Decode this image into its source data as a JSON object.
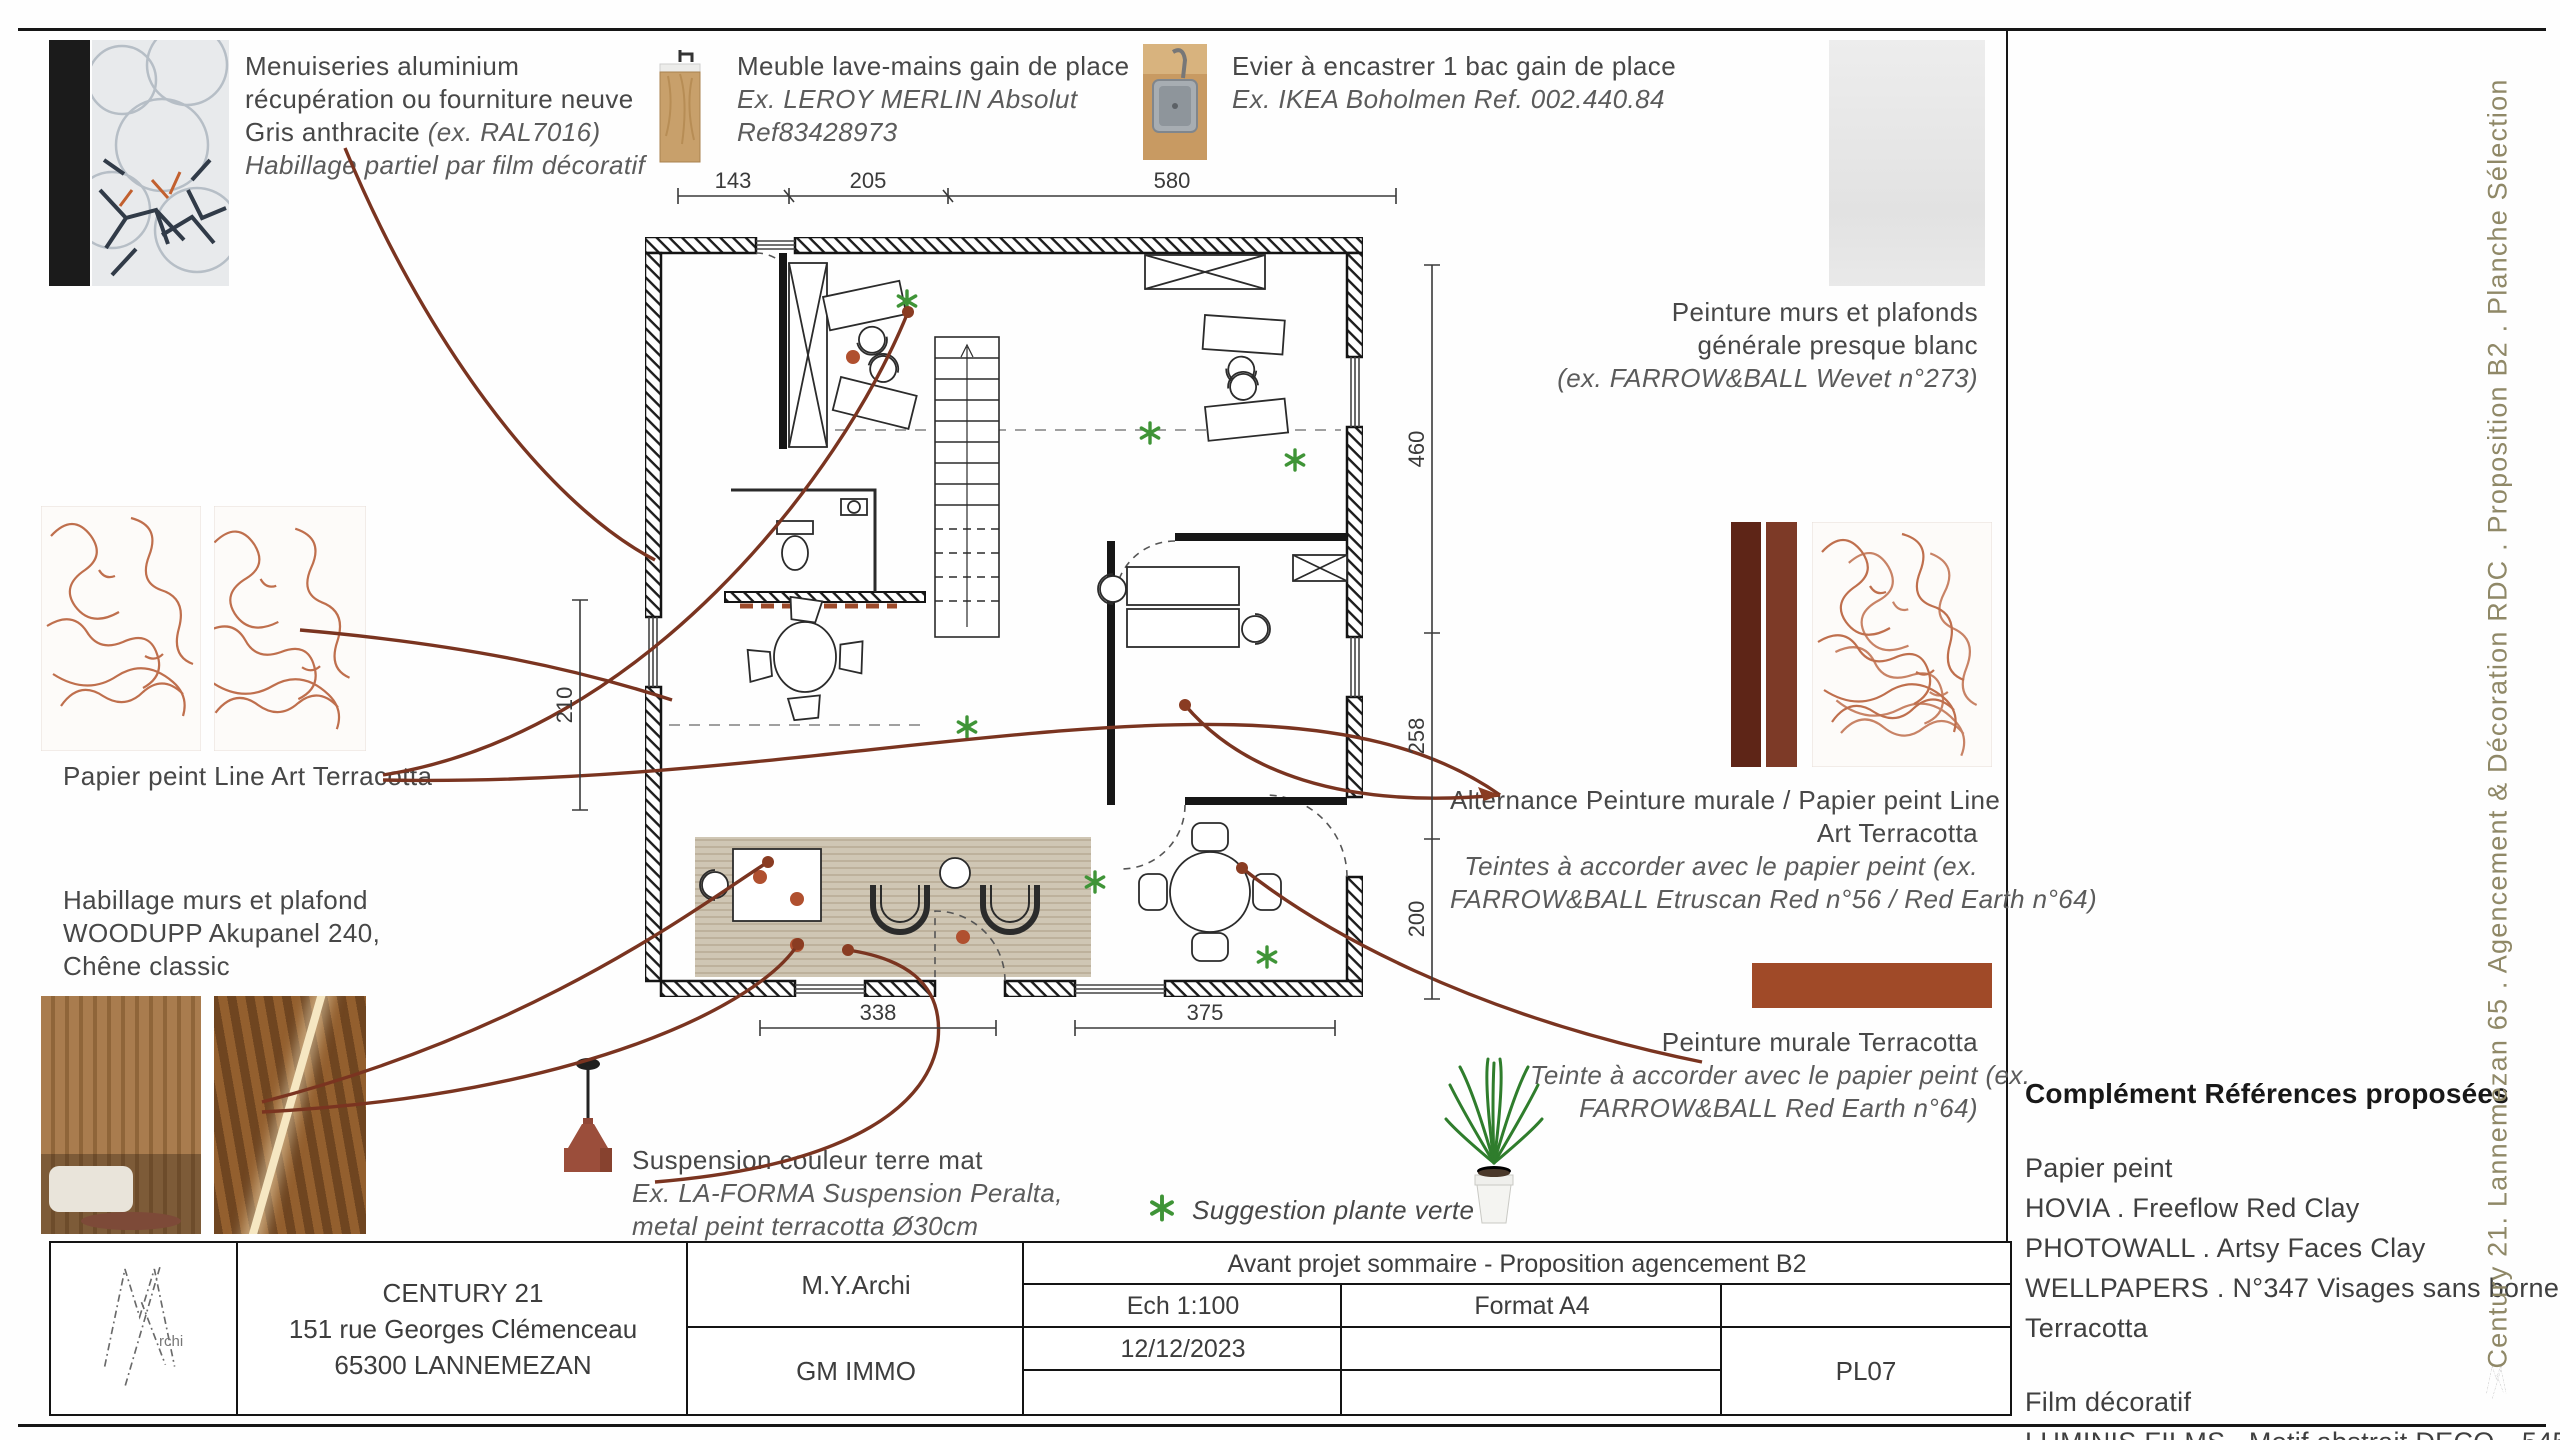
{
  "palette": {
    "terracotta_bar": "#a04a28",
    "paint_bar_dark": "#5e2517",
    "paint_bar_mid": "#7d3a27",
    "leader_line": "#7a3420",
    "plant_green": "#3f9437",
    "side_caption_color": "#8f8867"
  },
  "side_caption": "Century 21. Lannemezan 65 . Agencement & Décoration RDC . Proposition B2 . Planche Sélection",
  "annotations": {
    "menuiseries": {
      "l1": "Menuiseries aluminium",
      "l2": "récupération ou fourniture neuve",
      "l3a": "Gris anthracite ",
      "l3b": "(ex. RAL7016)",
      "l4": "Habillage partiel par film décoratif"
    },
    "meuble": {
      "l1": "Meuble lave-mains gain de place",
      "l2": "Ex. LEROY MERLIN Absolut",
      "l3": "Ref83428973"
    },
    "evier": {
      "l1": "Evier à encastrer 1 bac gain de place",
      "l2": "Ex. IKEA Boholmen Ref. 002.440.84"
    },
    "peinture_blanc": {
      "l1": "Peinture murs et plafonds",
      "l2": "générale presque blanc",
      "l3": "(ex. FARROW&BALL Wevet n°273)"
    },
    "papier_peint_label": "Papier peint Line Art Terracotta",
    "habillage": {
      "l1": "Habillage murs et plafond",
      "l2": "WOODUPP Akupanel 240,",
      "l3": "Chêne classic"
    },
    "alternance": {
      "l1": "Alternance Peinture murale / Papier peint Line",
      "l2": "Art Terracotta",
      "l3": "Teintes à accorder avec le papier peint (ex.",
      "l4": "FARROW&BALL Etruscan Red n°56 / Red Earth n°64)"
    },
    "peinture_terracotta": {
      "l1": "Peinture murale Terracotta",
      "l2": "Teinte à accorder avec le papier peint (ex.",
      "l3": "FARROW&BALL Red Earth n°64)"
    },
    "suspension": {
      "l1": "Suspension couleur terre mat",
      "l2": "Ex. LA-FORMA Suspension Peralta,",
      "l3": "metal peint terracotta Ø30cm"
    },
    "plante_label": "Suggestion plante verte"
  },
  "references": {
    "title": "Complément Références proposées",
    "g1_title": "Papier peint",
    "g1_items": [
      "HOVIA . Freeflow Red Clay",
      "PHOTOWALL . Artsy Faces Clay",
      "WELLPAPERS . N°347 Visages sans bornes",
      "Terracotta"
    ],
    "g2_title": "Film décoratif",
    "g2_items": [
      "LUMINIS FILMS . Motif abstrait DECO—545i"
    ]
  },
  "plan_dims": {
    "top": [
      "143",
      "205",
      "580"
    ],
    "right": [
      "460",
      "258",
      "200"
    ],
    "bottom": [
      "338",
      "375"
    ],
    "left": "210"
  },
  "titleblock": {
    "company": "CENTURY 21",
    "address1": "151 rue Georges Clémenceau",
    "address2": "65300 LANNEMEZAN",
    "architect": "M.Y.Archi",
    "client": "GM IMMO",
    "project": "Avant projet sommaire - Proposition agencement B2",
    "scale": "Ech 1:100",
    "format": "Format A4",
    "date": "12/12/2023",
    "sheet_number": "PL07",
    "logo_text": "rchi"
  }
}
